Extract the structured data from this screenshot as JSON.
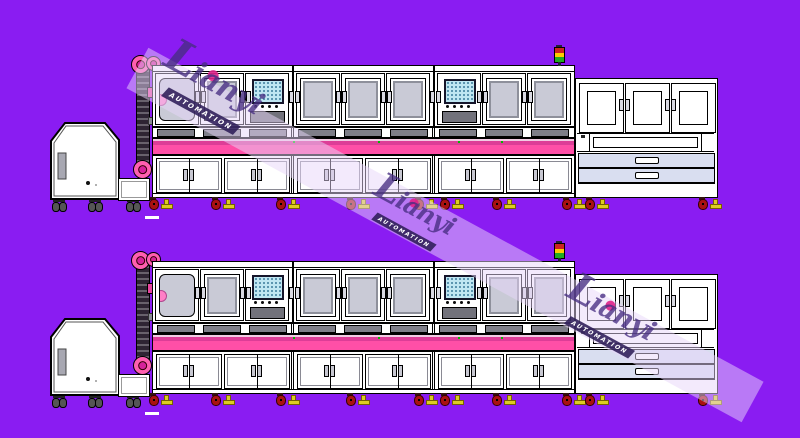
{
  "title": "Lianyi automation assembly line CAD drawing",
  "watermark": {
    "brand": "Lianyi",
    "subtitle": "AUTOMATION"
  },
  "scene": {
    "description": "Two identical side-view CAD drawings of an automated production line",
    "rows": [
      {
        "label": "production-line-1"
      },
      {
        "label": "production-line-2"
      }
    ],
    "line_components": [
      "feeder-hopper-machine",
      "elevator-chain-with-sprockets",
      "process-module-1-with-hmi-screen",
      "process-module-2",
      "process-module-3-with-hmi-screen",
      "signal-tower",
      "conveyor-belt",
      "cabinet-row",
      "end-station-with-drawers"
    ],
    "colors": {
      "background": "#8A1CF2",
      "machine-body": "#FFFFFF",
      "outline": "#000000",
      "conveyor-pink": "#FF4FA7",
      "conveyor-stripe": "#DD3D97",
      "sprocket-pink": "#FF5FB0",
      "window-glass": "#C9CAD6",
      "window-frame": "#8E909B",
      "vent-gray": "#7E7E88",
      "screen-blue": "#BFE6F2",
      "drawer-face": "#D9DEF0",
      "tower-red": "#CC2222",
      "tower-yellow": "#FFCC00",
      "tower-green": "#22AA22",
      "caster-red": "#A91111",
      "foot-yellow": "#DDCC22",
      "watermark-band": "rgba(232,214,250,0.5)",
      "watermark-text": "rgba(70,45,130,0.78)",
      "watermark-accent": "#E0218A"
    }
  }
}
